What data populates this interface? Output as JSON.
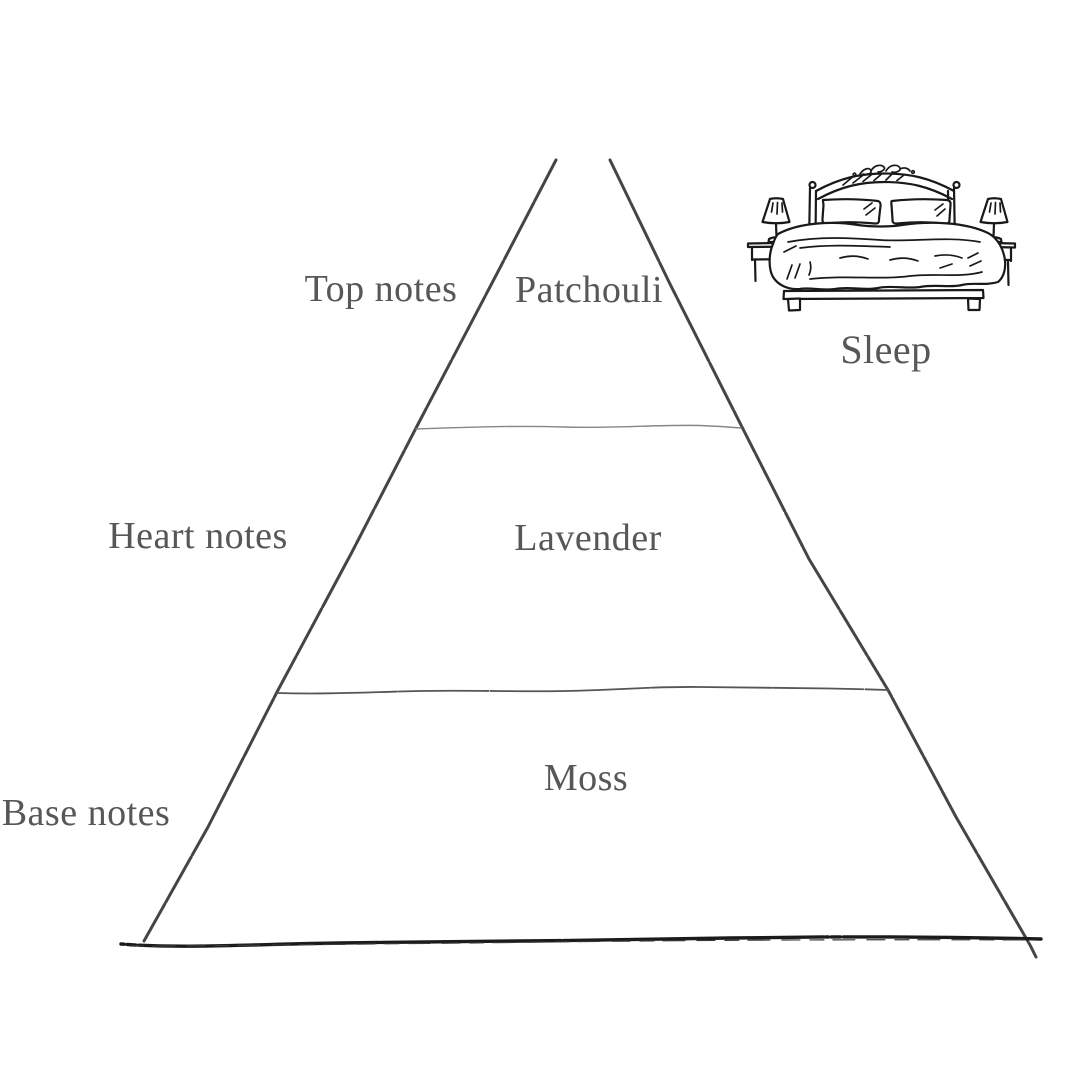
{
  "page": {
    "background": "#ffffff",
    "kind": "fragrance-note-pyramid-diagram"
  },
  "pyramid": {
    "levels": [
      {
        "category": "Top notes",
        "note": "Patchouli"
      },
      {
        "category": "Heart notes",
        "note": "Lavender"
      },
      {
        "category": "Base notes",
        "note": "Moss"
      }
    ]
  },
  "scene": {
    "icon": "bed-icon",
    "label": "Sleep"
  },
  "colors": {
    "background": "#ffffff",
    "text": "#57575a",
    "pyramid_edge": "#454545",
    "pyramid_base": "#1b1b1b",
    "divider_top": "#878787",
    "divider_bottom": "#565656",
    "bed_ink": "#191919"
  }
}
